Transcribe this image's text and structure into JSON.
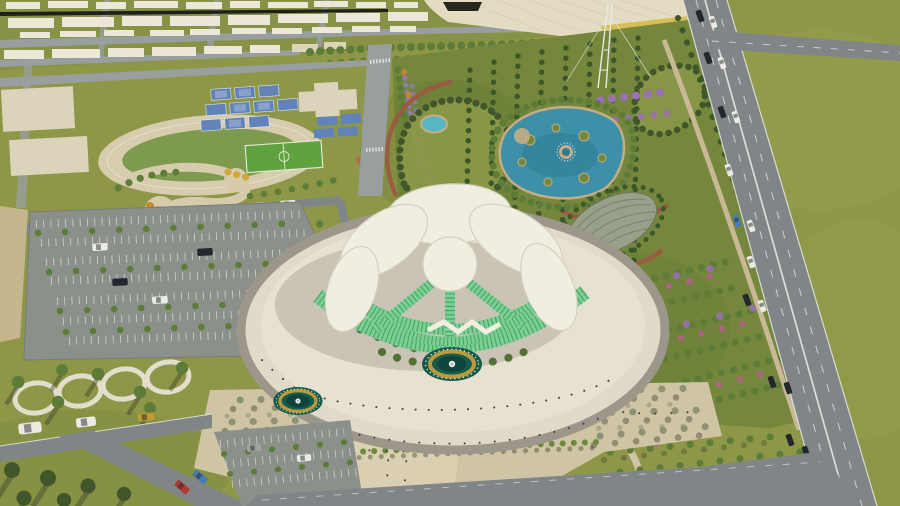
{
  "palette": {
    "field": "#8e9747",
    "fieldLight": "#9aa351",
    "cityLawn": "#879246",
    "dirtField": "#c6b68e",
    "roadGray": "#808688",
    "roadLight": "#999f9e",
    "asphaltLot": "#8b908b",
    "stripeWhite": "#e9e8df",
    "buildingWhite": "#ece7d9",
    "padCream": "#dcd3bb",
    "hallCream": "#e3dbc2",
    "hallYellow": "#d8be52",
    "darkLine": "#1f1f1d",
    "trackTan": "#d8ccae",
    "trackLane": "#e7dfc8",
    "infieldGreen": "#7e9a4e",
    "courtBlue": "#6283b8",
    "courtBlueLight": "#8aa2cb",
    "pitchGreen": "#5fa23e",
    "parkPath": "#d7cbad",
    "autumnOrange": "#c6882e",
    "autumnYellow": "#d2a838",
    "treeGreen": "#5d7c38",
    "treeDark": "#41572b",
    "cypress": "#3c5729",
    "espTree": "#8f9376",
    "hedgeGreen": "#6d8a3c",
    "gardenBase": "#75873d",
    "gardenLight": "#8b9848",
    "moundGray": "#99a089",
    "moundRib": "#7e8672",
    "redPath": "#9c5843",
    "lavender": "#9478b8",
    "purpleTree": "#9a6fb5",
    "pinkFlower": "#b75f8d",
    "pondBlue": "#3d90a8",
    "pondDeep": "#2e7a92",
    "poolAqua": "#56b6c4",
    "sandRim": "#c4ad85",
    "plazaCream": "#e0dac9",
    "plazaLight": "#e7e1d1",
    "plazaRing": "#9d978b",
    "esplanadeTan": "#cfc4a4",
    "walkLight": "#dacfb1",
    "fountainTeal": "#155a4b",
    "fountainDeep": "#0d453c",
    "fountainGold": "#b99a3e",
    "glassGreen": "#7ccf92",
    "glassDark": "#3f9c63",
    "roofWhite": "#f0ede1",
    "roofEdge": "#d6d0bf",
    "pavRed": "#b46a52",
    "carDark": "#24272c",
    "carWhite": "#eceae3",
    "carRed": "#b03a30",
    "carGold": "#c09a35",
    "carBlue": "#4a7ab5",
    "carGray": "#a3a39d",
    "mastWhite": "#e9e9e6",
    "person": "#44423c",
    "shadow": "rgba(55,58,40,0.40)",
    "shadowSoft": "rgba(55,58,40,0.22)",
    "buildingShadow": "rgba(45,50,38,0.16)"
  }
}
